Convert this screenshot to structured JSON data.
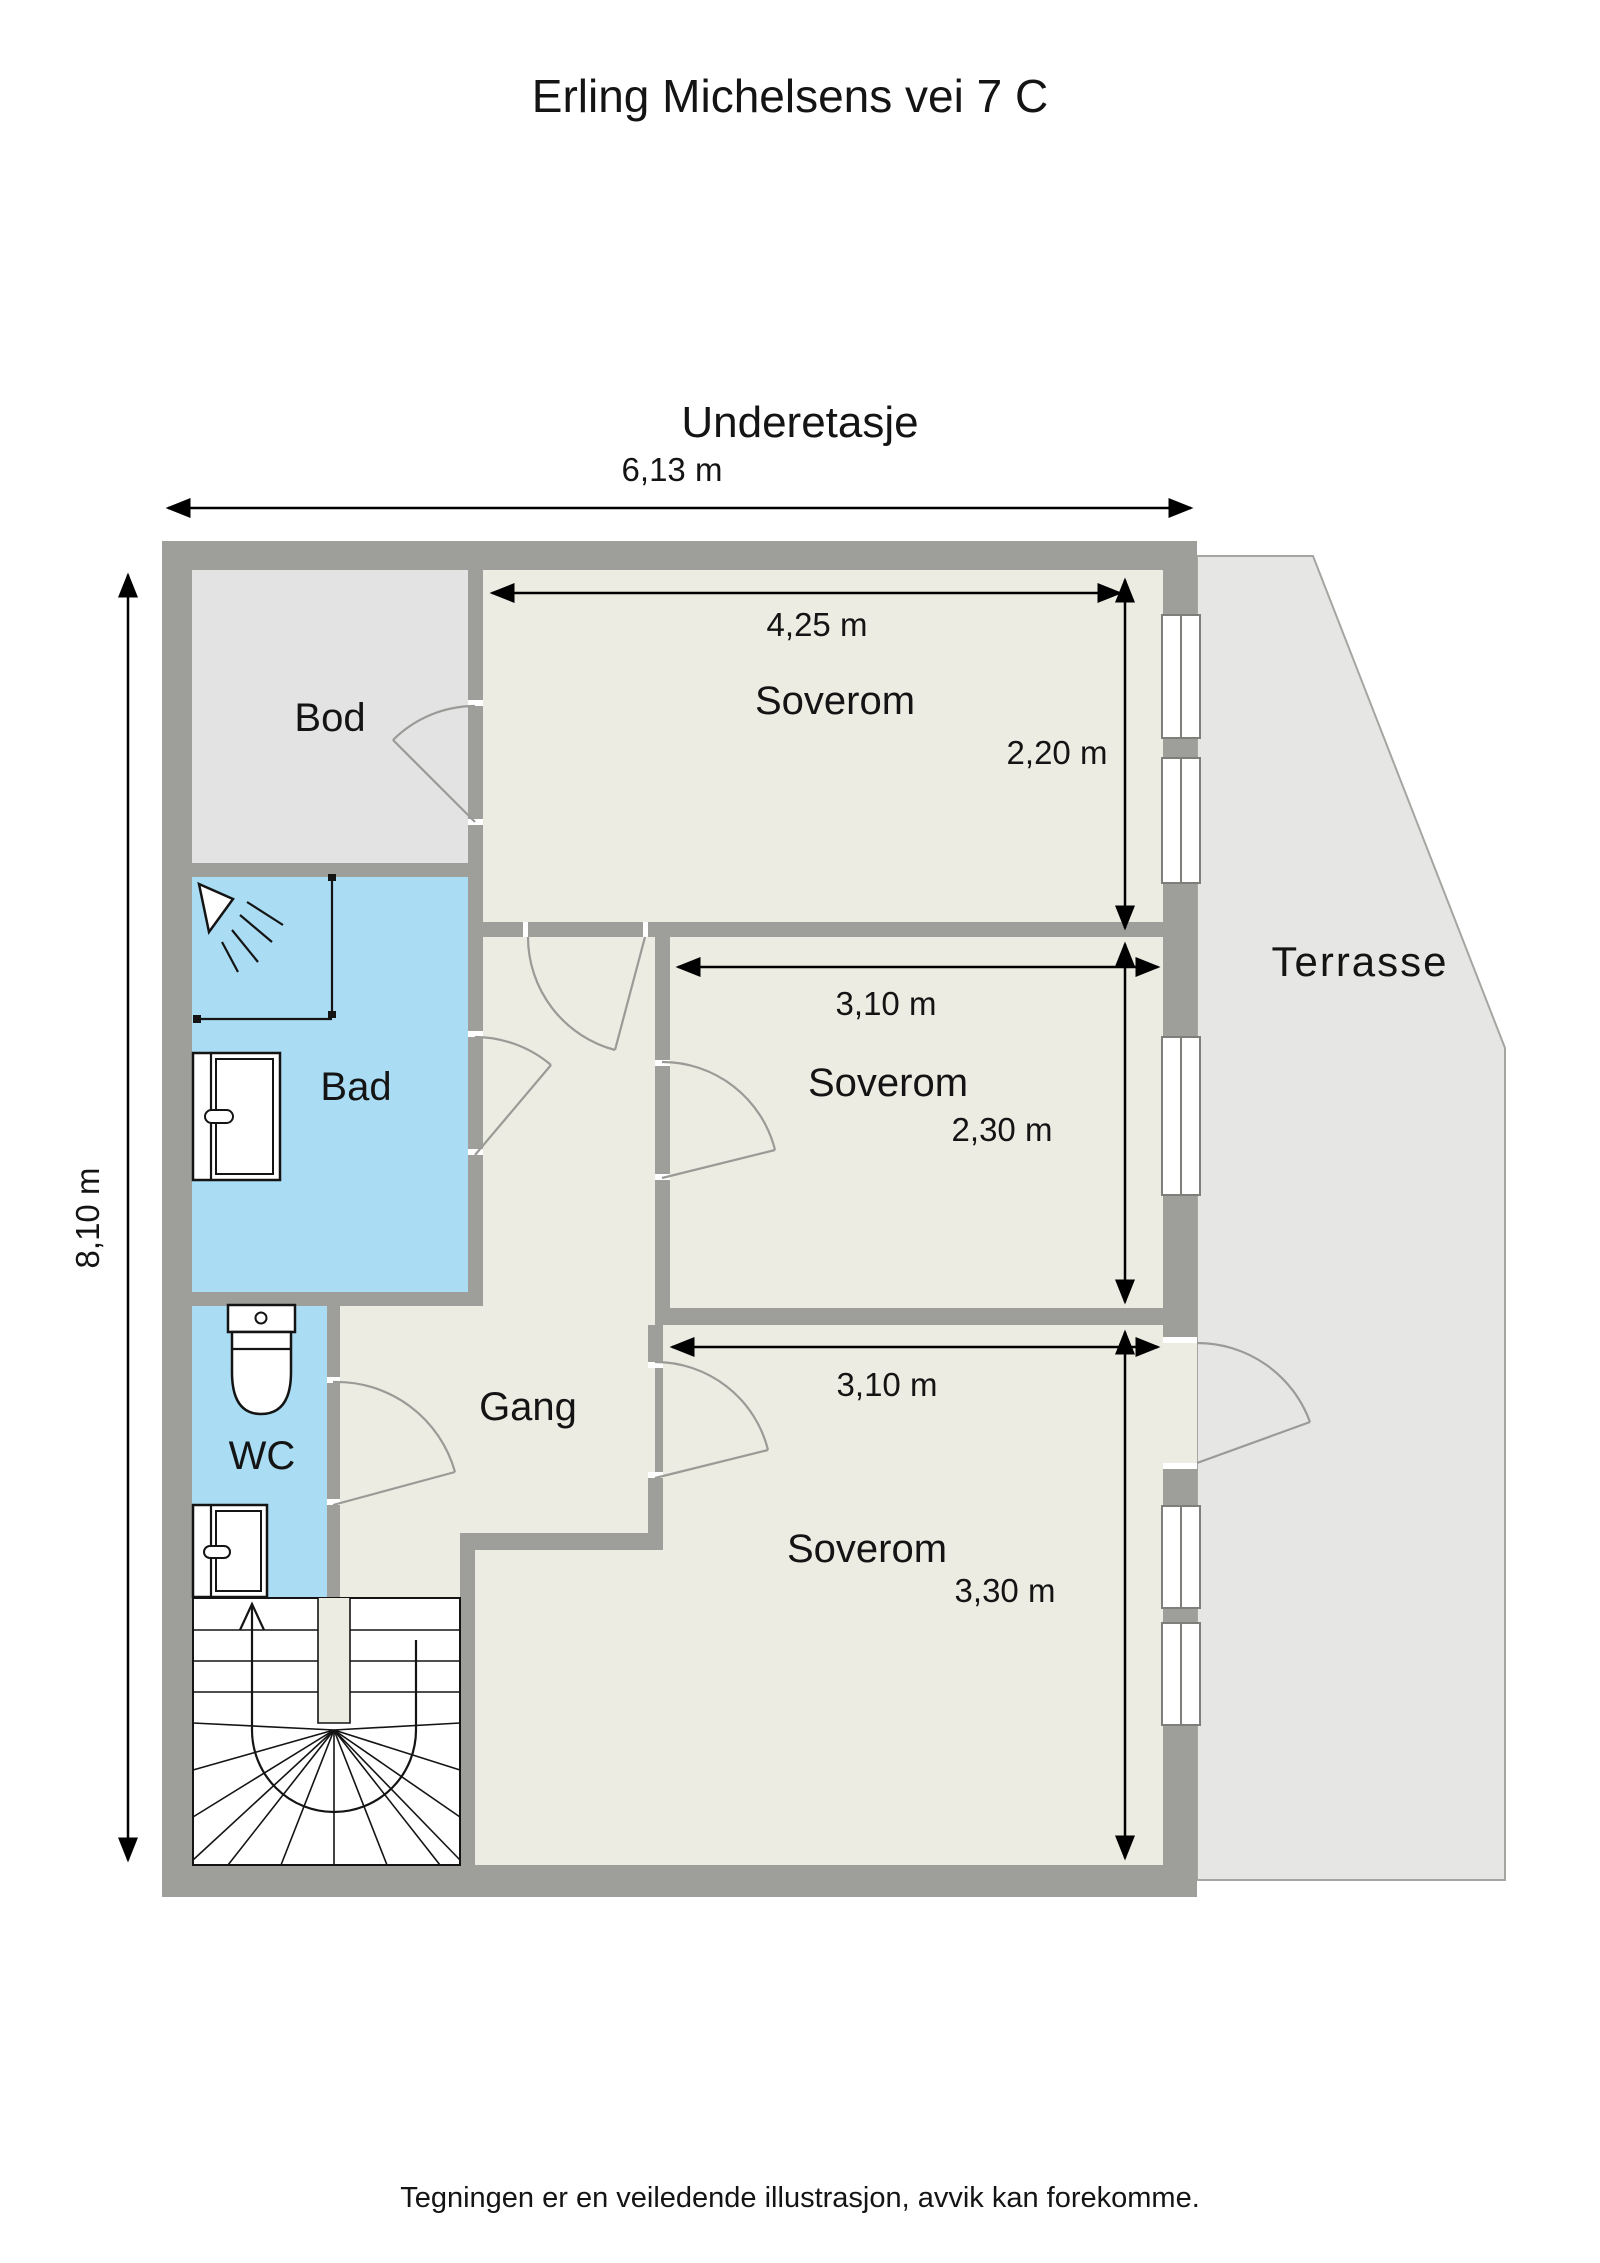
{
  "page": {
    "title": "Erling Michelsens vei 7 C",
    "floor_label": "Underetasje",
    "disclaimer": "Tegningen er en veiledende illustrasjon, avvik kan forekomme."
  },
  "overall_dimensions": {
    "width": "6,13 m",
    "height": "8,10 m"
  },
  "rooms": [
    {
      "id": "bod",
      "label": "Bod"
    },
    {
      "id": "soverom-1",
      "label": "Soverom",
      "width": "4,25 m",
      "height": "2,20 m"
    },
    {
      "id": "bad",
      "label": "Bad"
    },
    {
      "id": "soverom-2",
      "label": "Soverom",
      "width": "3,10 m",
      "height": "2,30 m"
    },
    {
      "id": "wc",
      "label": "WC"
    },
    {
      "id": "gang",
      "label": "Gang"
    },
    {
      "id": "soverom-3",
      "label": "Soverom",
      "width": "3,10 m",
      "height": "3,30 m"
    },
    {
      "id": "terrasse",
      "label": "Terrasse"
    }
  ],
  "fixtures": [
    "shower-head-icon",
    "shower-screen",
    "bathroom-cabinet",
    "toilet",
    "wc-cabinet",
    "winder-staircase",
    "stair-direction-arrow"
  ],
  "colors": {
    "wall": "#9e9e9a",
    "floor_main": "#ecece3",
    "floor_storage": "#e3e3e3",
    "floor_wet": "#aadcf3",
    "terrace": "#e6e6e5",
    "dimension_line": "#000000",
    "door_line": "#9a9a97"
  }
}
